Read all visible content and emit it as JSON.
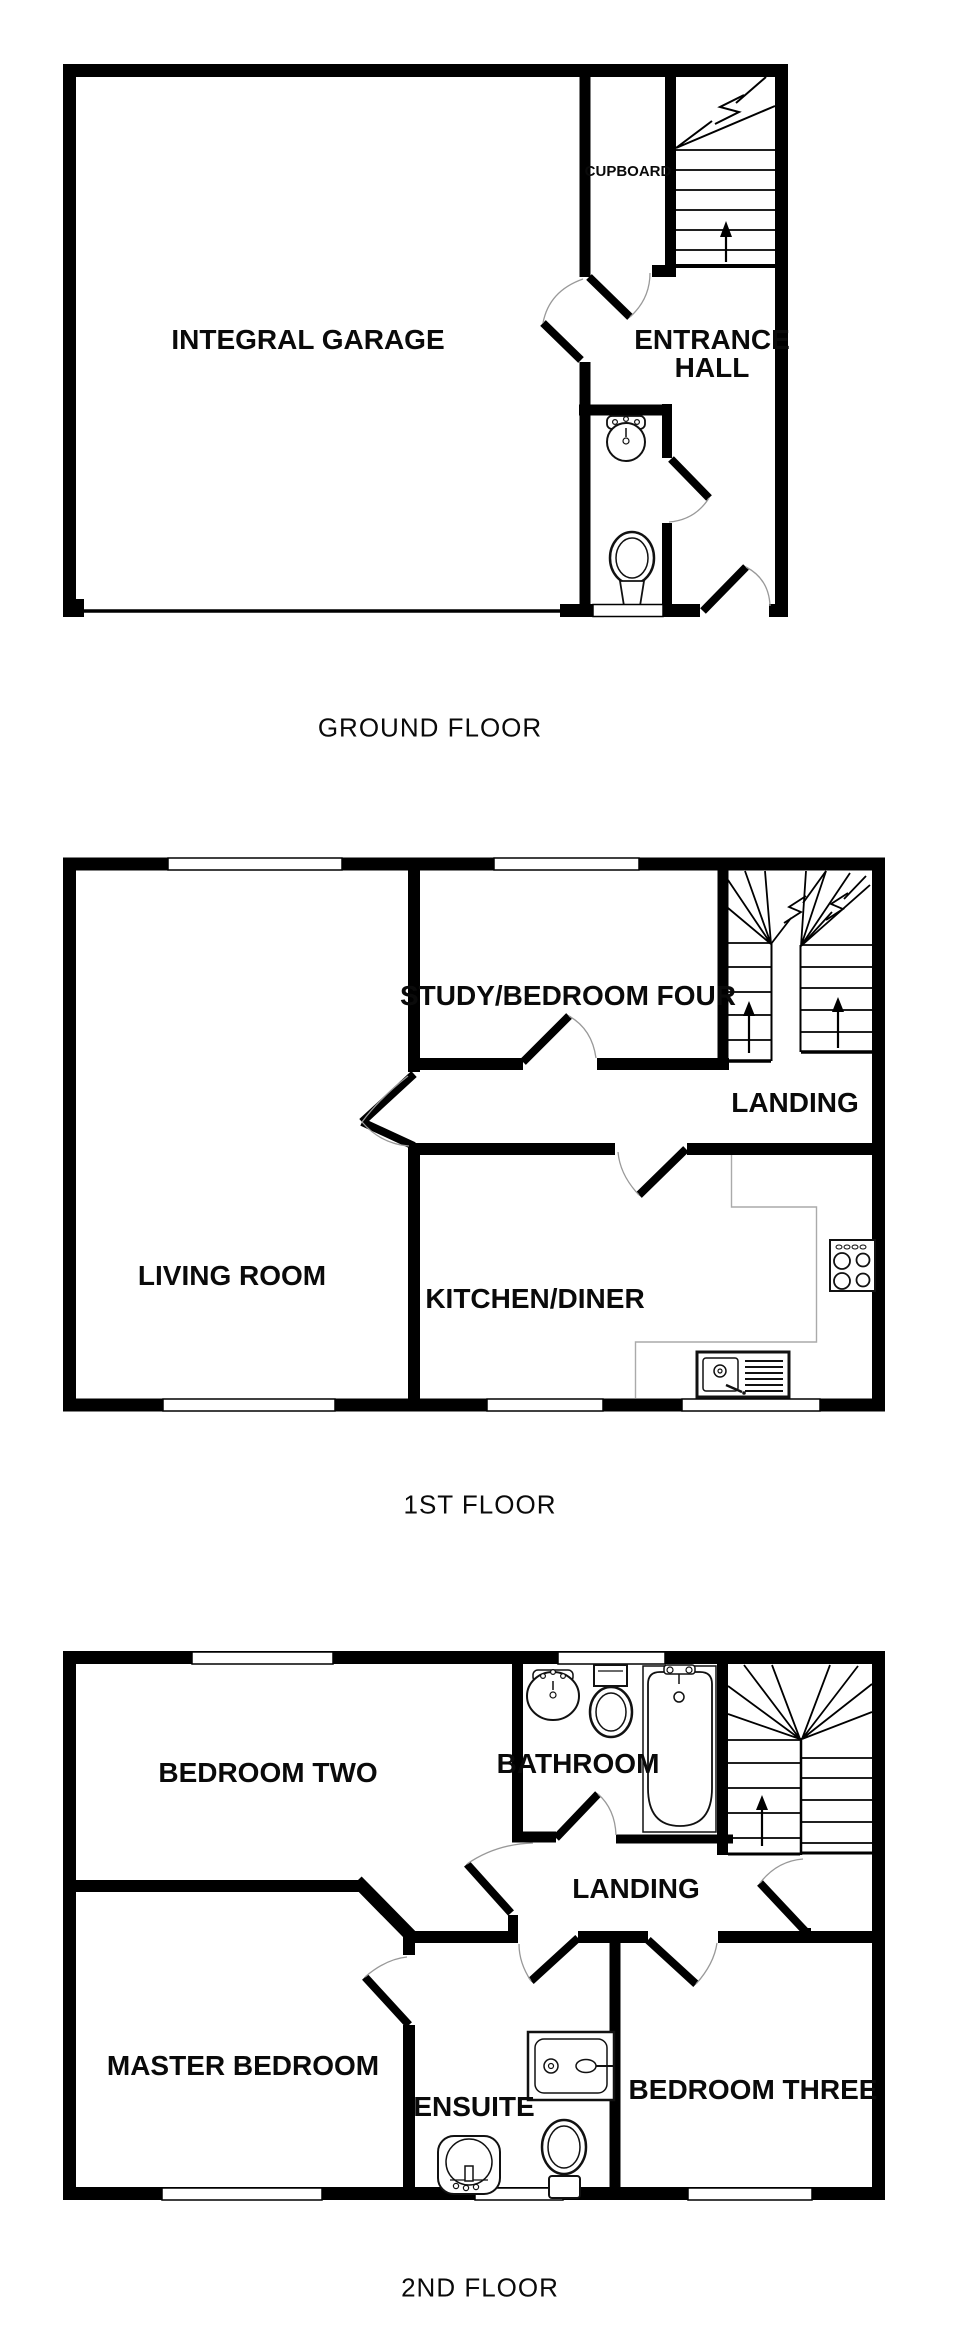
{
  "document_type": "property floor plan",
  "colors": {
    "wall": "#000000",
    "background": "#ffffff",
    "arc": "#999999",
    "counter": "#aaaaaa"
  },
  "floors": [
    {
      "caption": "GROUND FLOOR",
      "rooms": {
        "garage": "INTEGRAL GARAGE",
        "cupboard": "CUPBOARD",
        "entrance_hall": "ENTRANCE HALL"
      }
    },
    {
      "caption": "1ST FLOOR",
      "rooms": {
        "study": "STUDY/BEDROOM FOUR",
        "landing": "LANDING",
        "living": "LIVING ROOM",
        "kitchen": "KITCHEN/DINER"
      }
    },
    {
      "caption": "2ND FLOOR",
      "rooms": {
        "bedroom_two": "BEDROOM TWO",
        "bathroom": "BATHROOM",
        "landing": "LANDING",
        "master": "MASTER BEDROOM",
        "ensuite": "ENSUITE",
        "bedroom_three": "BEDROOM THREE"
      }
    }
  ],
  "fixtures": [
    "staircase-icon",
    "up-arrow-icon",
    "toilet-icon",
    "sink-icon",
    "bathtub-icon",
    "shower-icon",
    "cooktop-icon",
    "kitchen-sink-icon",
    "door-swing-icon",
    "window-icon"
  ]
}
